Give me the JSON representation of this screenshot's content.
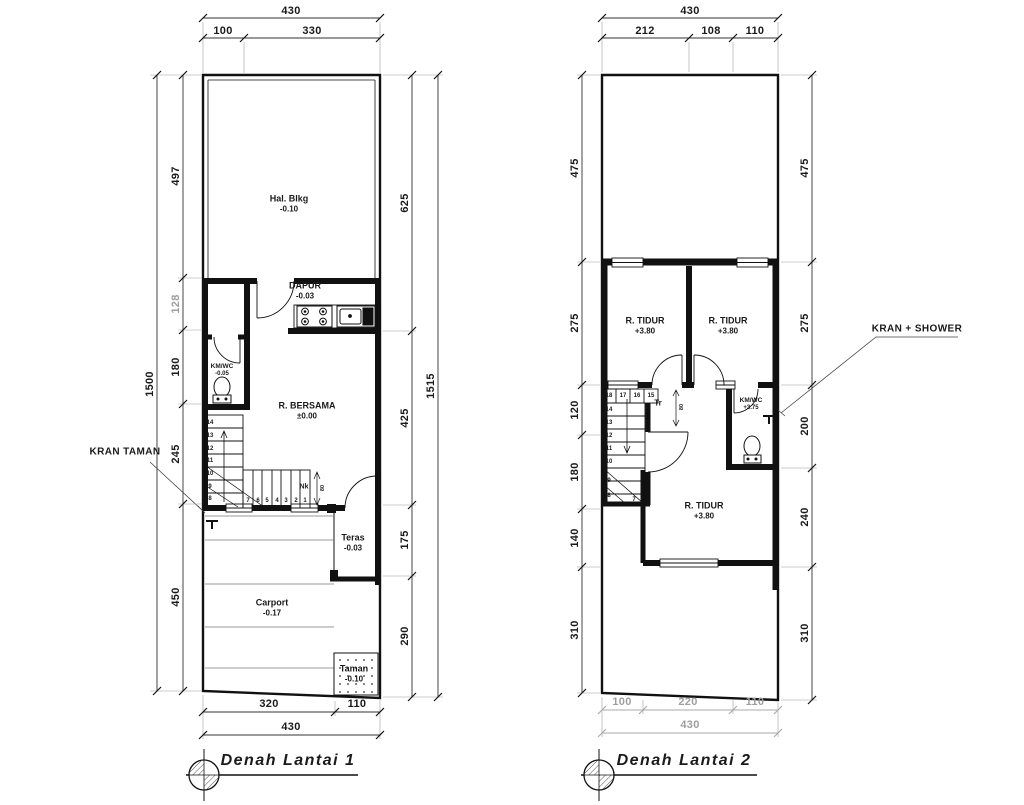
{
  "colors": {
    "ink": "#1a1a1a",
    "line": "#333333",
    "muted": "#9e9e9e",
    "paper": "#ffffff"
  },
  "plan1": {
    "title": "Denah Lantai 1",
    "dims": {
      "top_total": "430",
      "top_seg1": "100",
      "top_seg2": "330",
      "left_total": "1500",
      "left_seg1": "497",
      "left_seg2": "128",
      "left_seg3": "180",
      "left_seg4": "245",
      "left_seg5": "450",
      "right_total": "1515",
      "right_seg1": "625",
      "right_seg2": "425",
      "right_seg3": "175",
      "right_seg4": "290",
      "bottom_seg1": "320",
      "bottom_seg2": "110",
      "bottom_total": "430"
    },
    "rooms": {
      "hal_blkg": {
        "name": "Hal. Blkg",
        "level": "-0.10"
      },
      "dapur": {
        "name": "DAPUR",
        "level": "-0.03"
      },
      "kmwc": {
        "name": "KM/WC",
        "level": "-0.05"
      },
      "bersama": {
        "name": "R. BERSAMA",
        "level": "±0.00"
      },
      "teras": {
        "name": "Teras",
        "level": "-0.03"
      },
      "carport": {
        "name": "Carport",
        "level": "-0.17"
      },
      "taman": {
        "name": "Taman",
        "level": "-0.10"
      }
    },
    "stairs": {
      "flight": [
        "14",
        "13",
        "12",
        "11",
        "10",
        "9",
        "8"
      ],
      "run": [
        "7",
        "6",
        "5",
        "4",
        "3",
        "2",
        "1"
      ],
      "nosing_label": "Nk",
      "nosing_dim": "80"
    },
    "annotations": {
      "kran_taman": "KRAN TAMAN"
    }
  },
  "plan2": {
    "title": "Denah Lantai 2",
    "dims": {
      "top_total": "430",
      "top_seg1": "212",
      "top_seg2": "108",
      "top_seg3": "110",
      "left_seg1": "475",
      "left_seg2": "275",
      "left_seg3": "120",
      "left_seg4": "180",
      "left_seg5": "140",
      "left_seg6": "310",
      "right_seg1": "475",
      "right_seg2": "275",
      "right_seg3": "200",
      "right_seg4": "240",
      "right_seg5": "310",
      "bottom_seg1": "100",
      "bottom_seg2": "220",
      "bottom_seg3": "110",
      "bottom_total": "430"
    },
    "rooms": {
      "tidur1": {
        "name": "R. TIDUR",
        "level": "+3.80"
      },
      "tidur2": {
        "name": "R. TIDUR",
        "level": "+3.80"
      },
      "tidur3": {
        "name": "R. TIDUR",
        "level": "+3.80"
      },
      "kmwc": {
        "name": "KM/WC",
        "level": "+3.75"
      }
    },
    "stairs": {
      "top_row": [
        "18",
        "17",
        "16",
        "15"
      ],
      "flight": [
        "14",
        "13",
        "12",
        "11",
        "10",
        "9",
        "8"
      ],
      "landing": "7",
      "tr_label": "Tr",
      "tr_dim": "80"
    },
    "annotations": {
      "kran_shower": "KRAN + SHOWER"
    }
  }
}
